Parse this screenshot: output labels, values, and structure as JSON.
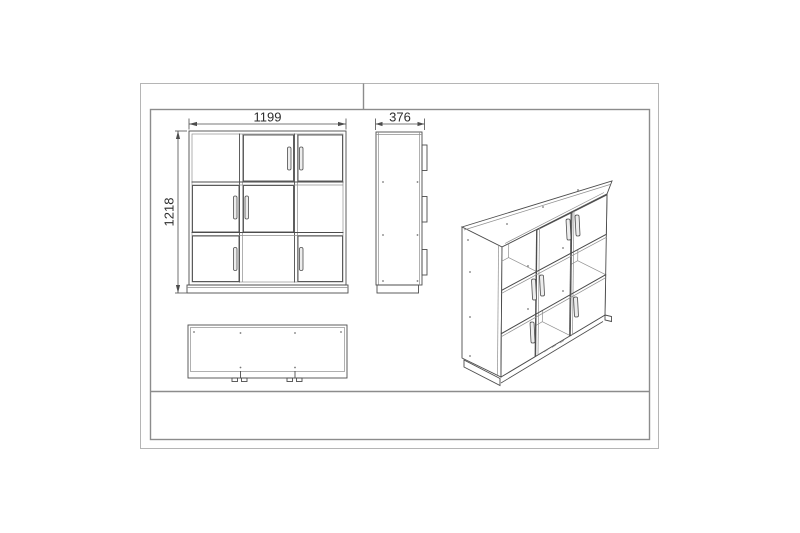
{
  "drawing": {
    "views": {
      "front": {
        "width_mm": "1199",
        "height_mm": "1218"
      },
      "side": {
        "depth_mm": "376"
      }
    },
    "colors": {
      "background": "#ffffff",
      "main_line": "#4d4d4d",
      "light_line": "#8f8f8f",
      "frame_inner": "#8c8c8c",
      "frame_outer": "#b5b5b5",
      "dimension_text": "#2d2d2d"
    }
  }
}
